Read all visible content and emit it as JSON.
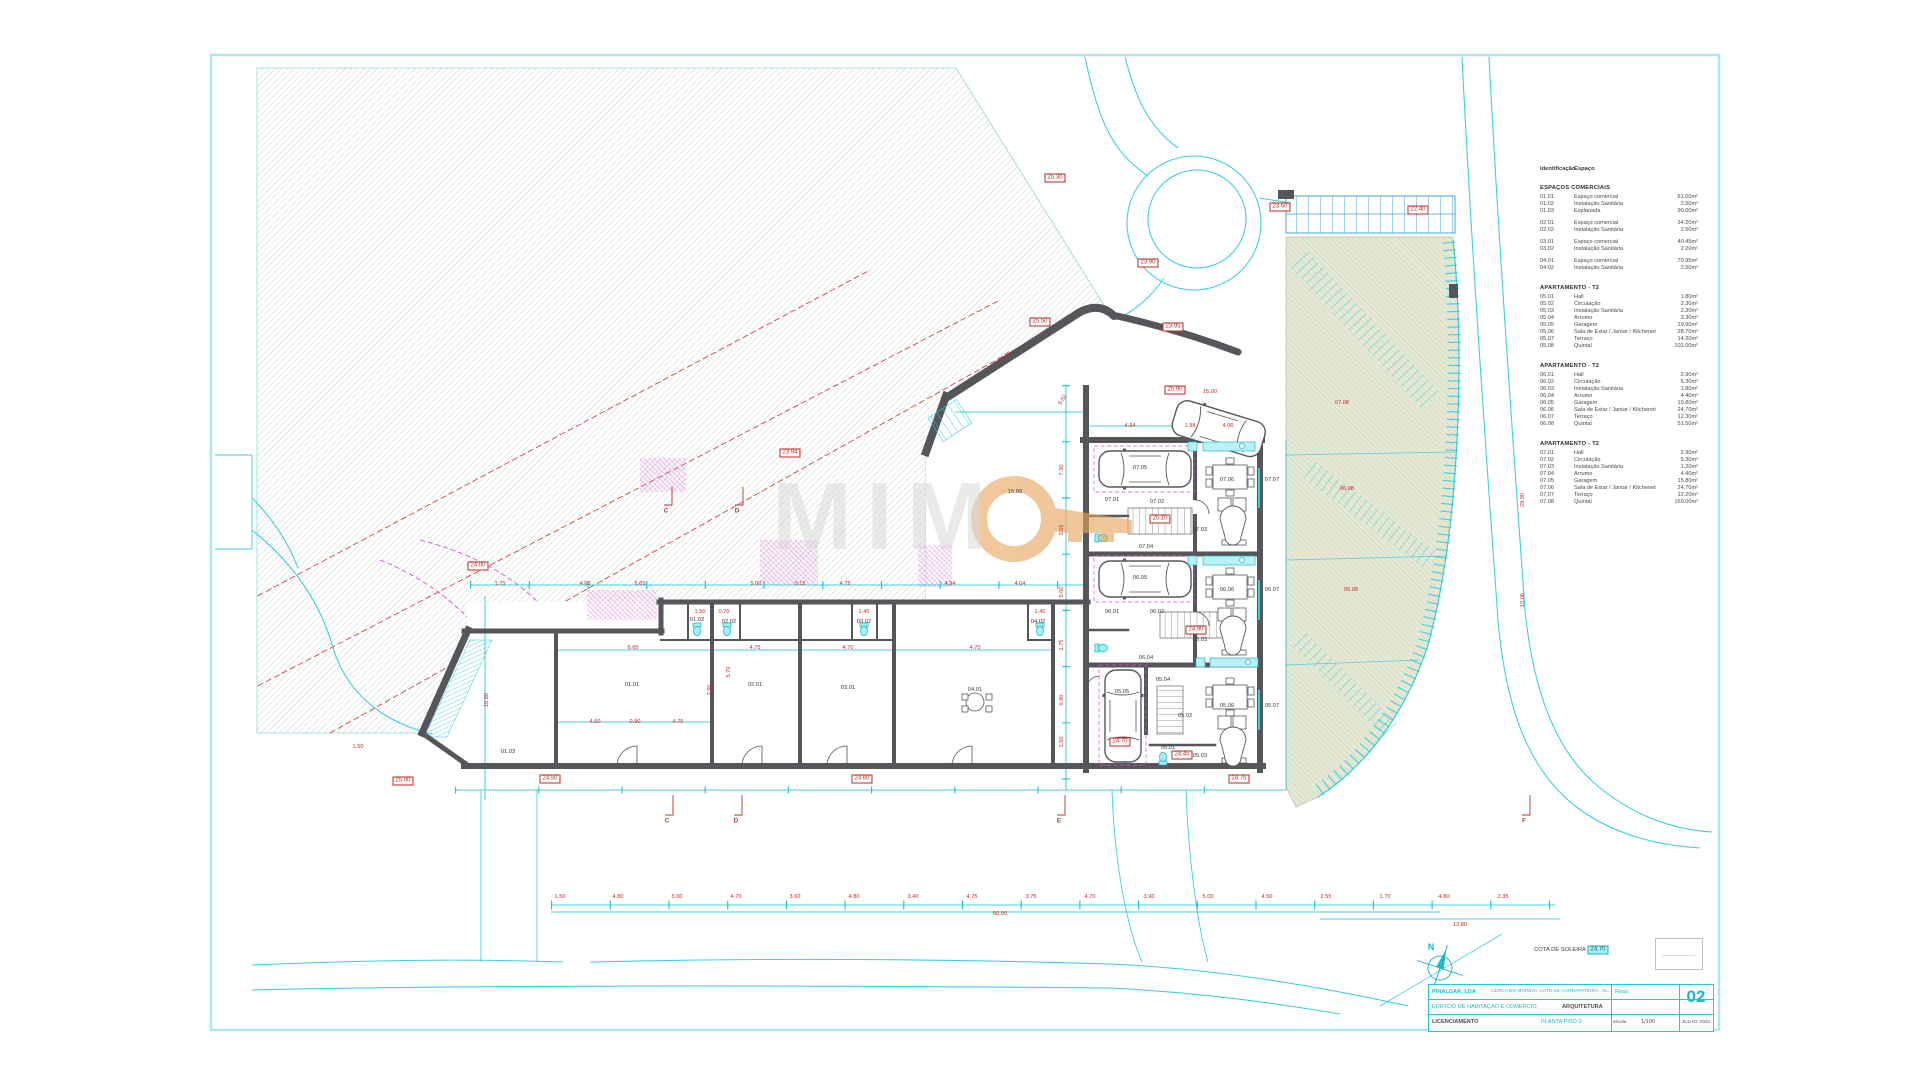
{
  "sheet": {
    "number": "02"
  },
  "watermark": {
    "letters": "MIM",
    "o_icon": "orange-ring-key"
  },
  "colors": {
    "cyan": "#2ec9da",
    "pale_cyan": "#abe9ee",
    "dim_cyan": "#10bfd4",
    "wall_gray": "#54565a",
    "hatch_gray": "#c2c4c6",
    "red": "#c22a21",
    "magenta": "#d84fd8",
    "green_fill": "#e4e8d5",
    "green_line": "#c4cfae",
    "orange": "#e8a55e",
    "stair_blue": "#4aa3d8"
  },
  "legend": {
    "header_id": "Identificação",
    "header_space": "Espaço",
    "sections": [
      {
        "title": "ESPAÇOS COMERCIAIS",
        "rows": [
          {
            "id": "01.01",
            "name": "Espaço comercial",
            "area": "61.00m²"
          },
          {
            "id": "01.02",
            "name": "Instalação Sanitária",
            "area": "2.50m²"
          },
          {
            "id": "01.03",
            "name": "Esplanada",
            "area": "90.00m²"
          },
          {
            "id": "02.01",
            "name": "Espaço comercial",
            "area": "34.20m²",
            "g": true
          },
          {
            "id": "02.02",
            "name": "Instalação Sanitária",
            "area": "2.50m²"
          },
          {
            "id": "03.01",
            "name": "Espaço comercial",
            "area": "40.45m²",
            "g": true
          },
          {
            "id": "03.02",
            "name": "Instalação Sanitária",
            "area": "2.20m²"
          },
          {
            "id": "04.01",
            "name": "Espaço comercial",
            "area": "70.95m²",
            "g": true
          },
          {
            "id": "04.02",
            "name": "Instalação Sanitária",
            "area": "2.50m²"
          }
        ]
      },
      {
        "title": "APARTAMENTO - T2",
        "rows": [
          {
            "id": "05.01",
            "name": "Hall",
            "area": "1.80m²"
          },
          {
            "id": "05.02",
            "name": "Circulação",
            "area": "2.30m²"
          },
          {
            "id": "05.03",
            "name": "Instalação Sanitária",
            "area": "2.30m²"
          },
          {
            "id": "05.04",
            "name": "Arrumo",
            "area": "3.30m²"
          },
          {
            "id": "05.05",
            "name": "Garagem",
            "area": "19.90m²"
          },
          {
            "id": "05.06",
            "name": "Sala de Estar / Jantar / Kitchenet",
            "area": "28.70m²"
          },
          {
            "id": "05.07",
            "name": "Terraço",
            "area": "14.20m²"
          },
          {
            "id": "05.08",
            "name": "Quintal",
            "area": "102.00m²"
          }
        ]
      },
      {
        "title": "APARTAMENTO - T2",
        "rows": [
          {
            "id": "06.01",
            "name": "Hall",
            "area": "2.90m²"
          },
          {
            "id": "06.02",
            "name": "Circulação",
            "area": "5.30m²"
          },
          {
            "id": "06.03",
            "name": "Instalação Sanitária",
            "area": "1.80m²"
          },
          {
            "id": "06.04",
            "name": "Arrumo",
            "area": "4.40m²"
          },
          {
            "id": "06.05",
            "name": "Garagem",
            "area": "19.80m²"
          },
          {
            "id": "06.06",
            "name": "Sala de Estar / Jantar / Kitchenet",
            "area": "24.70m²"
          },
          {
            "id": "06.07",
            "name": "Terraço",
            "area": "12.30m²"
          },
          {
            "id": "06.08",
            "name": "Quintal",
            "area": "51.50m²"
          }
        ]
      },
      {
        "title": "APARTAMENTO - T2",
        "rows": [
          {
            "id": "07.01",
            "name": "Hall",
            "area": "2.90m²"
          },
          {
            "id": "07.02",
            "name": "Circulação",
            "area": "5.30m²"
          },
          {
            "id": "07.03",
            "name": "Instalação Sanitária",
            "area": "1.20m²"
          },
          {
            "id": "07.04",
            "name": "Arrumo",
            "area": "4.40m²"
          },
          {
            "id": "07.05",
            "name": "Garagem",
            "area": "15.80m²"
          },
          {
            "id": "07.06",
            "name": "Sala de Estar / Jantar / Kitchenet",
            "area": "24.70m²"
          },
          {
            "id": "07.07",
            "name": "Terraço",
            "area": "12.20m²"
          },
          {
            "id": "07.08",
            "name": "Quintal",
            "area": "169.00m²"
          }
        ]
      }
    ]
  },
  "titleblock": {
    "client": "PINALGAR, LDA",
    "location": "CERCA DO MOINHO, LOTE 19, CARRAPATEIRA - ALJEZUR",
    "resp_label": "Resp.",
    "project": "EDIFÍCIO DE HABITAÇÃO E COMÉRCIO",
    "specialty": "ARQUITETURA",
    "phase": "LICENCIAMENTO",
    "drawing": "PLANTA PISO 0",
    "scale_label": "escala",
    "scale": "1/100",
    "month": "JULHO",
    "year": "2021",
    "number": "02"
  },
  "cota_soleira": {
    "label": "COTA DE SOLEIRA",
    "value": "24.70"
  },
  "north_label": "N",
  "annotations": [
    {
      "t": "24.50",
      "x": 550,
      "y": 779,
      "c": "b"
    },
    {
      "t": "24.60",
      "x": 862,
      "y": 779,
      "c": "b"
    },
    {
      "t": "24.75",
      "x": 1239,
      "y": 779,
      "c": "b"
    },
    {
      "t": "25.00",
      "x": 403,
      "y": 781,
      "c": "b"
    },
    {
      "t": "24.00",
      "x": 478,
      "y": 566,
      "c": "b"
    },
    {
      "t": "23.94",
      "x": 790,
      "y": 453,
      "c": "b"
    },
    {
      "t": "25.50",
      "x": 1040,
      "y": 322,
      "c": "b"
    },
    {
      "t": "23.95",
      "x": 1173,
      "y": 327,
      "c": "b"
    },
    {
      "t": "23.50",
      "x": 1280,
      "y": 207,
      "c": "b"
    },
    {
      "t": "22.40",
      "x": 1418,
      "y": 210,
      "c": "b"
    },
    {
      "t": "25.30",
      "x": 1055,
      "y": 178,
      "c": "b"
    },
    {
      "t": "23.90",
      "x": 1148,
      "y": 263,
      "c": "b"
    },
    {
      "t": "24.70",
      "x": 1120,
      "y": 742,
      "c": "b"
    },
    {
      "t": "24.45",
      "x": 1182,
      "y": 755,
      "c": "b"
    },
    {
      "t": "25.90",
      "x": 1175,
      "y": 390,
      "c": "b"
    },
    {
      "t": "25.10",
      "x": 1160,
      "y": 519,
      "c": "b"
    },
    {
      "t": "24.90",
      "x": 1196,
      "y": 630,
      "c": "b"
    },
    {
      "t": "24.70",
      "x": 1598,
      "y": 950,
      "c": "bc"
    },
    {
      "t": "COTA DE SOLEIRA",
      "x": 1560,
      "y": 950,
      "c": "k"
    },
    {
      "t": "N",
      "x": 1431,
      "y": 947,
      "c": "cy"
    },
    {
      "t": "1.75",
      "x": 500,
      "y": 584,
      "c": "r"
    },
    {
      "t": "4.60",
      "x": 585,
      "y": 584,
      "c": "r"
    },
    {
      "t": "6.65",
      "x": 640,
      "y": 584,
      "c": "r"
    },
    {
      "t": "5.00",
      "x": 756,
      "y": 584,
      "c": "r"
    },
    {
      "t": "0.15",
      "x": 800,
      "y": 584,
      "c": "r"
    },
    {
      "t": "4.75",
      "x": 845,
      "y": 584,
      "c": "r"
    },
    {
      "t": "4.94",
      "x": 950,
      "y": 584,
      "c": "r"
    },
    {
      "t": "4.04",
      "x": 1020,
      "y": 584,
      "c": "r"
    },
    {
      "t": "6.65",
      "x": 633,
      "y": 648,
      "c": "r"
    },
    {
      "t": "4.75",
      "x": 755,
      "y": 648,
      "c": "r"
    },
    {
      "t": "4.70",
      "x": 848,
      "y": 648,
      "c": "r"
    },
    {
      "t": "4.70",
      "x": 975,
      "y": 648,
      "c": "r"
    },
    {
      "t": "4.60",
      "x": 595,
      "y": 722,
      "c": "r"
    },
    {
      "t": "0.90",
      "x": 635,
      "y": 722,
      "c": "r"
    },
    {
      "t": "4.75",
      "x": 678,
      "y": 722,
      "c": "r"
    },
    {
      "t": "7.50",
      "x": 710,
      "y": 690,
      "c": "r",
      "r": -90
    },
    {
      "t": "5.70",
      "x": 729,
      "y": 672,
      "c": "r",
      "r": -90
    },
    {
      "t": "10.80",
      "x": 487,
      "y": 700,
      "c": "r",
      "r": -90
    },
    {
      "t": "7.30",
      "x": 1062,
      "y": 470,
      "c": "r",
      "r": -90
    },
    {
      "t": "3.05",
      "x": 1062,
      "y": 530,
      "c": "r",
      "r": -90
    },
    {
      "t": "5.00",
      "x": 1062,
      "y": 592,
      "c": "r",
      "r": -90
    },
    {
      "t": "1.75",
      "x": 1062,
      "y": 645,
      "c": "r",
      "r": -90
    },
    {
      "t": "0.80",
      "x": 1062,
      "y": 700,
      "c": "r",
      "r": -90
    },
    {
      "t": "1.50",
      "x": 1062,
      "y": 742,
      "c": "r",
      "r": -90
    },
    {
      "t": "29.90",
      "x": 1523,
      "y": 500,
      "c": "r",
      "r": -90
    },
    {
      "t": "15.06",
      "x": 1523,
      "y": 600,
      "c": "r",
      "r": -90
    },
    {
      "t": "14.55",
      "x": 1005,
      "y": 357,
      "c": "r",
      "r": -33
    },
    {
      "t": "5.02",
      "x": 1063,
      "y": 400,
      "c": "r",
      "r": -57
    },
    {
      "t": "4.94",
      "x": 1130,
      "y": 426,
      "c": "r"
    },
    {
      "t": "1.98",
      "x": 1190,
      "y": 426,
      "c": "r"
    },
    {
      "t": "4.06",
      "x": 1228,
      "y": 426,
      "c": "r"
    },
    {
      "t": "15.00",
      "x": 1210,
      "y": 392,
      "c": "r"
    },
    {
      "t": "1.50",
      "x": 700,
      "y": 612,
      "c": "r"
    },
    {
      "t": "0.70",
      "x": 724,
      "y": 612,
      "c": "r"
    },
    {
      "t": "1.45",
      "x": 864,
      "y": 612,
      "c": "r"
    },
    {
      "t": "1.40",
      "x": 1040,
      "y": 612,
      "c": "r"
    },
    {
      "t": "1.50",
      "x": 560,
      "y": 897,
      "c": "r"
    },
    {
      "t": "4.80",
      "x": 618,
      "y": 897,
      "c": "r"
    },
    {
      "t": "5.00",
      "x": 677,
      "y": 897,
      "c": "r"
    },
    {
      "t": "4.70",
      "x": 736,
      "y": 897,
      "c": "r"
    },
    {
      "t": "3.60",
      "x": 795,
      "y": 897,
      "c": "r"
    },
    {
      "t": "4.80",
      "x": 854,
      "y": 897,
      "c": "r"
    },
    {
      "t": "3.40",
      "x": 913,
      "y": 897,
      "c": "r"
    },
    {
      "t": "4.75",
      "x": 972,
      "y": 897,
      "c": "r"
    },
    {
      "t": "3.75",
      "x": 1031,
      "y": 897,
      "c": "r"
    },
    {
      "t": "4.70",
      "x": 1090,
      "y": 897,
      "c": "r"
    },
    {
      "t": "3.90",
      "x": 1149,
      "y": 897,
      "c": "r"
    },
    {
      "t": "5.00",
      "x": 1208,
      "y": 897,
      "c": "r"
    },
    {
      "t": "4.50",
      "x": 1267,
      "y": 897,
      "c": "r"
    },
    {
      "t": "2.55",
      "x": 1326,
      "y": 897,
      "c": "r"
    },
    {
      "t": "1.70",
      "x": 1385,
      "y": 897,
      "c": "r"
    },
    {
      "t": "4.80",
      "x": 1444,
      "y": 897,
      "c": "r"
    },
    {
      "t": "2.35",
      "x": 1503,
      "y": 897,
      "c": "r"
    },
    {
      "t": "50.90",
      "x": 1000,
      "y": 914,
      "c": "r"
    },
    {
      "t": "12.80",
      "x": 1460,
      "y": 925,
      "c": "r"
    },
    {
      "t": "07.08",
      "x": 1342,
      "y": 403,
      "c": "r"
    },
    {
      "t": "06.08",
      "x": 1347,
      "y": 489,
      "c": "r"
    },
    {
      "t": "05.08",
      "x": 1351,
      "y": 590,
      "c": "r"
    },
    {
      "t": "1.50",
      "x": 358,
      "y": 747,
      "c": "r"
    },
    {
      "t": "01.01",
      "x": 632,
      "y": 685,
      "c": "k"
    },
    {
      "t": "02.01",
      "x": 755,
      "y": 685,
      "c": "k"
    },
    {
      "t": "03.01",
      "x": 848,
      "y": 688,
      "c": "k"
    },
    {
      "t": "04.01",
      "x": 975,
      "y": 690,
      "c": "k"
    },
    {
      "t": "01.02",
      "x": 697,
      "y": 620,
      "c": "k"
    },
    {
      "t": "02.02",
      "x": 729,
      "y": 622,
      "c": "k"
    },
    {
      "t": "03.02",
      "x": 864,
      "y": 622,
      "c": "k"
    },
    {
      "t": "04.02",
      "x": 1038,
      "y": 622,
      "c": "k"
    },
    {
      "t": "01.03",
      "x": 508,
      "y": 752,
      "c": "k"
    },
    {
      "t": "15.00",
      "x": 1015,
      "y": 492,
      "c": "k"
    },
    {
      "t": "07.05",
      "x": 1140,
      "y": 468,
      "c": "k"
    },
    {
      "t": "07.01",
      "x": 1112,
      "y": 500,
      "c": "k"
    },
    {
      "t": "07.02",
      "x": 1157,
      "y": 502,
      "c": "k"
    },
    {
      "t": "07.04",
      "x": 1146,
      "y": 547,
      "c": "k"
    },
    {
      "t": "07.03",
      "x": 1200,
      "y": 530,
      "c": "k"
    },
    {
      "t": "07.06",
      "x": 1227,
      "y": 480,
      "c": "k"
    },
    {
      "t": "07.07",
      "x": 1272,
      "y": 480,
      "c": "k"
    },
    {
      "t": "06.05",
      "x": 1140,
      "y": 578,
      "c": "k"
    },
    {
      "t": "06.01",
      "x": 1112,
      "y": 612,
      "c": "k"
    },
    {
      "t": "06.02",
      "x": 1157,
      "y": 612,
      "c": "k"
    },
    {
      "t": "06.04",
      "x": 1146,
      "y": 658,
      "c": "k"
    },
    {
      "t": "06.03",
      "x": 1200,
      "y": 640,
      "c": "k"
    },
    {
      "t": "06.06",
      "x": 1227,
      "y": 590,
      "c": "k"
    },
    {
      "t": "06.07",
      "x": 1272,
      "y": 590,
      "c": "k"
    },
    {
      "t": "05.05",
      "x": 1122,
      "y": 692,
      "c": "k"
    },
    {
      "t": "05.01",
      "x": 1168,
      "y": 748,
      "c": "k"
    },
    {
      "t": "05.02",
      "x": 1185,
      "y": 716,
      "c": "k"
    },
    {
      "t": "05.03",
      "x": 1200,
      "y": 756,
      "c": "k"
    },
    {
      "t": "05.04",
      "x": 1163,
      "y": 680,
      "c": "k"
    },
    {
      "t": "05.06",
      "x": 1227,
      "y": 706,
      "c": "k"
    },
    {
      "t": "05.07",
      "x": 1272,
      "y": 706,
      "c": "k"
    },
    {
      "t": "C",
      "x": 666,
      "y": 511,
      "c": "m"
    },
    {
      "t": "D",
      "x": 737,
      "y": 511,
      "c": "m"
    },
    {
      "t": "C",
      "x": 667,
      "y": 821,
      "c": "m"
    },
    {
      "t": "D",
      "x": 736,
      "y": 821,
      "c": "m"
    },
    {
      "t": "E",
      "x": 1059,
      "y": 821,
      "c": "m"
    },
    {
      "t": "F",
      "x": 1524,
      "y": 821,
      "c": "m"
    }
  ]
}
